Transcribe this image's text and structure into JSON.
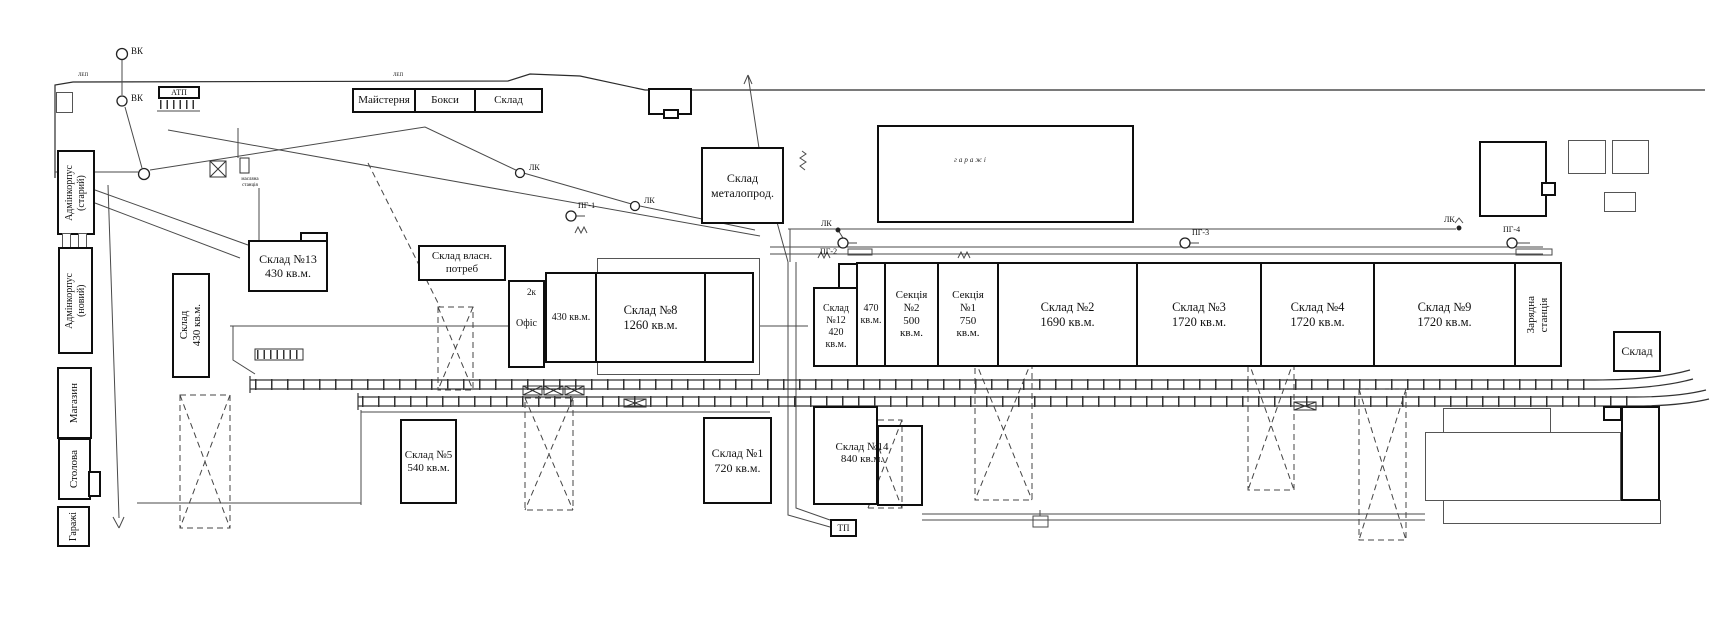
{
  "buildings": {
    "admin_old": "Адмінкорпус\n(старий)",
    "admin_new": "Адмінкорпус\n(новий)",
    "shop": "Магазин",
    "canteen": "Столова",
    "garages_small": "Гаражі",
    "atp": "АТП",
    "workshop": "Майстерня",
    "boxes": "Бокси",
    "sklad_top": "Склад",
    "sklad13": "Склад №13\n430 кв.м.",
    "sklad_own_needs": "Склад власн.\nпотреб",
    "sklad430_vertical": "Склад\n430 кв.м.",
    "office": "Офіс",
    "office_floors": "2к",
    "area430": "430 кв.м.",
    "sklad8": "Склад №8\n1260 кв.м.",
    "sklad_metal": "Склад\nметалопрод.",
    "garages_big": "гаражі",
    "sklad12": "Склад\n№12\n420\nкв.м.",
    "area470": "470\nкв.м.",
    "section2": "Секція\n№2\n500\nкв.м.",
    "section1": "Секція\n№1\n750\nкв.м.",
    "sklad2": "Склад №2\n1690 кв.м.",
    "sklad3": "Склад №3\n1720 кв.м.",
    "sklad4": "Склад №4\n1720 кв.м.",
    "sklad9": "Склад №9\n1720 кв.м.",
    "charging_station": "Зарядна\nстанція",
    "sklad_far_right": "Склад",
    "sklad5": "Склад №5\n540 кв.м.",
    "sklad1": "Склад №1\n720 кв.м.",
    "sklad14": "Склад №14\n840 кв.м.",
    "tp": "ТП"
  },
  "markers": {
    "vk": "ВК",
    "lk": "ЛК",
    "pg1": "ПГ-1",
    "pg2": "ПГ-2",
    "pg3": "ПГ-3",
    "pg4": "ПГ-4",
    "lep": "ЛЕП",
    "oil_station": "масляна\nстанція"
  }
}
